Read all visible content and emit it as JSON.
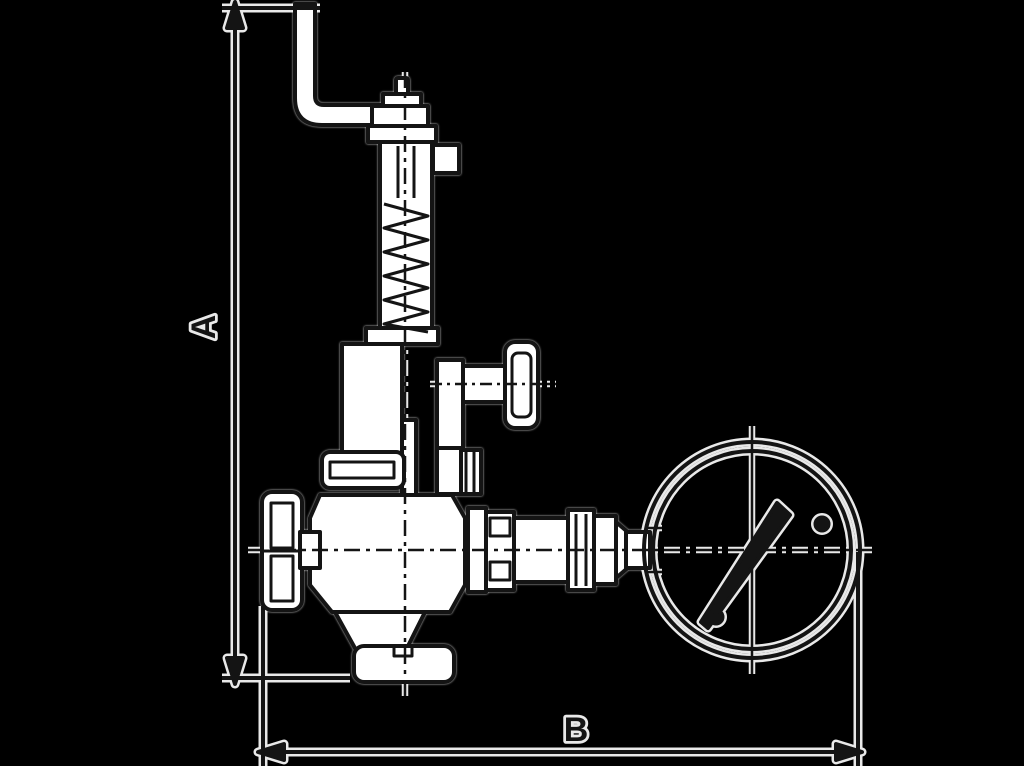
{
  "page": {
    "background": "#000000"
  },
  "diagram": {
    "alt": "Dimensional outline drawing of a safety relief valve with test lever, spring bonnet, hand knob, side test connection and pressure gauge",
    "dimension_labels": {
      "vertical": "A",
      "horizontal": "B"
    },
    "colors": {
      "background": "#000000",
      "ink": "#141414",
      "halo": "#e9e9e9",
      "fill": "#ffffff"
    },
    "components": [
      "test-lever",
      "top-pin",
      "cap-nut",
      "spring-bonnet",
      "spring",
      "side-test-connection",
      "test-connection-knob",
      "mid-flange",
      "valve-body",
      "hand-knob",
      "outlet-skirt",
      "outlet-flange",
      "gauge-fitting",
      "pressure-gauge",
      "gauge-needle",
      "dimension-line-A",
      "dimension-line-B"
    ]
  }
}
